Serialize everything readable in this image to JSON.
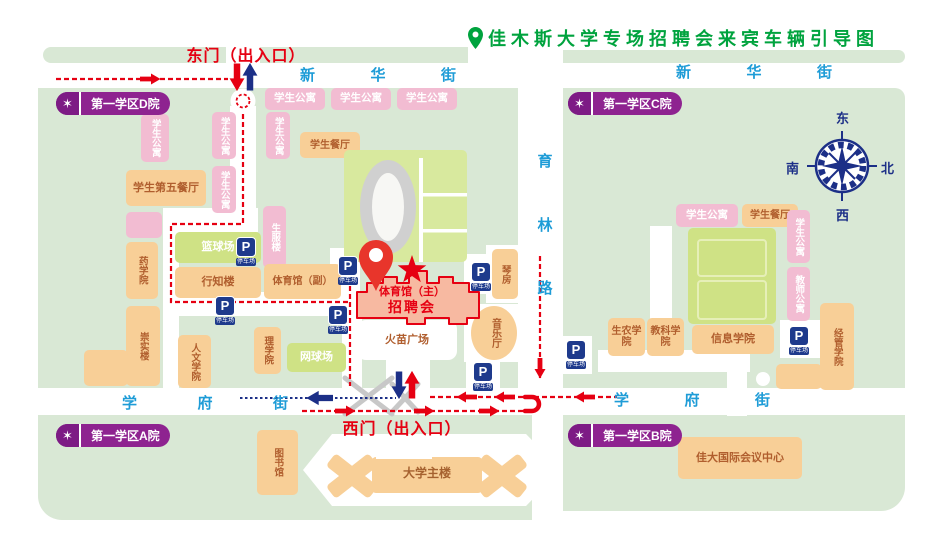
{
  "title": {
    "text": "佳木斯大学专场招聘会来宾车辆引导图"
  },
  "gates": {
    "east": "东门（出入口）",
    "west": "西门（出入口）"
  },
  "streets": {
    "xinhua": "新华街",
    "xuefu": "学府街",
    "yulin": "育林路"
  },
  "compass": {
    "top": "东",
    "right": "北",
    "bottom": "西",
    "left": "南"
  },
  "badge_star": "✶",
  "badges": [
    {
      "id": "district-d",
      "label": "第一学区D院",
      "x": 56,
      "y": 92
    },
    {
      "id": "district-c",
      "label": "第一学区C院",
      "x": 568,
      "y": 92
    },
    {
      "id": "district-a",
      "label": "第一学区A院",
      "x": 56,
      "y": 424
    },
    {
      "id": "district-b",
      "label": "第一学区B院",
      "x": 568,
      "y": 424
    }
  ],
  "venue": {
    "line1": "体育馆（主）",
    "line2": "招聘会"
  },
  "parking": {
    "symbol": "P",
    "caption": "停车场",
    "spots": [
      {
        "x": 236,
        "y": 237
      },
      {
        "x": 215,
        "y": 296
      },
      {
        "x": 338,
        "y": 256
      },
      {
        "x": 328,
        "y": 305
      },
      {
        "x": 471,
        "y": 262
      },
      {
        "x": 473,
        "y": 362
      },
      {
        "x": 566,
        "y": 340
      },
      {
        "x": 789,
        "y": 326
      }
    ]
  },
  "map": {
    "buildings": [
      {
        "id": "apt-w1",
        "label": "学生公寓",
        "x": 265,
        "y": 88,
        "w": 60,
        "h": 22,
        "kind": "pink"
      },
      {
        "id": "apt-w2",
        "label": "学生公寓",
        "x": 331,
        "y": 88,
        "w": 60,
        "h": 22,
        "kind": "pink"
      },
      {
        "id": "apt-w3",
        "label": "学生公寓",
        "x": 397,
        "y": 88,
        "w": 60,
        "h": 22,
        "kind": "pink"
      },
      {
        "id": "apt-w4",
        "label": "学生公寓",
        "x": 141,
        "y": 114,
        "w": 28,
        "h": 48,
        "kind": "pink",
        "v": 1
      },
      {
        "id": "apt-w5",
        "label": "学生公寓",
        "x": 212,
        "y": 112,
        "w": 24,
        "h": 47,
        "kind": "pink",
        "v": 1
      },
      {
        "id": "apt-w6",
        "label": "学生公寓",
        "x": 212,
        "y": 166,
        "w": 24,
        "h": 47,
        "kind": "pink",
        "v": 1
      },
      {
        "id": "apt-w7",
        "label": "学生公寓",
        "x": 266,
        "y": 112,
        "w": 24,
        "h": 47,
        "kind": "pink",
        "v": 1
      },
      {
        "id": "canteen-west",
        "label": "学生餐厅",
        "x": 300,
        "y": 132,
        "w": 60,
        "h": 26,
        "kind": "orange",
        "fs": 10
      },
      {
        "id": "canteen-no5",
        "label": "学生第五餐厅",
        "x": 126,
        "y": 170,
        "w": 80,
        "h": 36,
        "kind": "orange",
        "fs": 11
      },
      {
        "id": "annex",
        "label": "",
        "x": 126,
        "y": 212,
        "w": 36,
        "h": 26,
        "kind": "pink"
      },
      {
        "id": "pharmacy-college",
        "label": "药学院",
        "x": 126,
        "y": 242,
        "w": 32,
        "h": 57,
        "kind": "orange",
        "v": 1
      },
      {
        "id": "chongshi-bldg",
        "label": "崇实楼",
        "x": 126,
        "y": 306,
        "w": 34,
        "h": 80,
        "kind": "orange",
        "v": 1
      },
      {
        "id": "chongshi-foot",
        "label": "",
        "x": 84,
        "y": 350,
        "w": 44,
        "h": 36,
        "kind": "orange"
      },
      {
        "id": "shengfu-bldg",
        "label": "生服楼",
        "x": 263,
        "y": 206,
        "w": 23,
        "h": 62,
        "kind": "pink",
        "v": 1
      },
      {
        "id": "basketball-court",
        "label": "篮球场",
        "x": 175,
        "y": 232,
        "w": 86,
        "h": 31,
        "kind": "court"
      },
      {
        "id": "xingzhi-bldg",
        "label": "行知楼",
        "x": 175,
        "y": 267,
        "w": 86,
        "h": 31,
        "kind": "orange",
        "fs": 11
      },
      {
        "id": "gym-aux",
        "label": "体育馆（副）",
        "x": 264,
        "y": 264,
        "w": 77,
        "h": 35,
        "kind": "orange",
        "fs": 10
      },
      {
        "id": "humanities-college",
        "label": "人文学院",
        "x": 178,
        "y": 335,
        "w": 33,
        "h": 53,
        "kind": "orange",
        "v": 1
      },
      {
        "id": "science-college",
        "label": "理学院",
        "x": 254,
        "y": 327,
        "w": 27,
        "h": 47,
        "kind": "orange",
        "v": 1
      },
      {
        "id": "tennis-court",
        "label": "网球场",
        "x": 287,
        "y": 343,
        "w": 59,
        "h": 29,
        "kind": "court"
      },
      {
        "id": "library",
        "label": "图书馆",
        "x": 257,
        "y": 430,
        "w": 41,
        "h": 65,
        "kind": "orange",
        "v": 1
      },
      {
        "id": "stadium-field",
        "label": "",
        "x": 344,
        "y": 150,
        "w": 123,
        "h": 112,
        "kind": "field"
      },
      {
        "id": "stadium-label",
        "label": "体育场",
        "x": 377,
        "y": 172,
        "w": 21,
        "h": 76,
        "kind": "slabel",
        "v": 1,
        "fs": 11
      },
      {
        "id": "piano-rooms",
        "label": "琴房",
        "x": 492,
        "y": 249,
        "w": 26,
        "h": 50,
        "kind": "orange",
        "v": 1
      },
      {
        "id": "music-hall-label",
        "label": "音乐厅",
        "x": 484,
        "y": 309,
        "w": 21,
        "h": 48,
        "kind": "olabel",
        "v": 1,
        "fs": 10
      },
      {
        "id": "flame-plaza",
        "label": "火苗广场",
        "x": 357,
        "y": 320,
        "w": 100,
        "h": 40,
        "kind": "plaza",
        "fs": 11
      },
      {
        "id": "main-bldg-label",
        "label": "大学主楼",
        "x": 372,
        "y": 462,
        "w": 110,
        "h": 24,
        "kind": "tlabel"
      },
      {
        "id": "apt-e1",
        "label": "学生公寓",
        "x": 676,
        "y": 204,
        "w": 62,
        "h": 23,
        "kind": "pink"
      },
      {
        "id": "canteen-east",
        "label": "学生餐厅",
        "x": 742,
        "y": 204,
        "w": 56,
        "h": 23,
        "kind": "orange",
        "fs": 10
      },
      {
        "id": "apt-e2",
        "label": "学生公寓",
        "x": 787,
        "y": 210,
        "w": 23,
        "h": 53,
        "kind": "pink",
        "v": 1
      },
      {
        "id": "teacher-apt",
        "label": "教师公寓",
        "x": 787,
        "y": 267,
        "w": 23,
        "h": 54,
        "kind": "pink",
        "v": 1
      },
      {
        "id": "courts-east",
        "label": "",
        "x": 688,
        "y": 228,
        "w": 88,
        "h": 96,
        "kind": "court"
      },
      {
        "id": "shengnong-college",
        "label": "生农学院",
        "x": 608,
        "y": 318,
        "w": 37,
        "h": 38,
        "kind": "orange",
        "fs": 10
      },
      {
        "id": "jiaoke-college",
        "label": "教科学院",
        "x": 647,
        "y": 318,
        "w": 37,
        "h": 38,
        "kind": "orange",
        "fs": 10
      },
      {
        "id": "info-college",
        "label": "信息学院",
        "x": 692,
        "y": 325,
        "w": 82,
        "h": 29,
        "kind": "orange",
        "fs": 11
      },
      {
        "id": "jingguan-college",
        "label": "经管学院",
        "x": 820,
        "y": 303,
        "w": 34,
        "h": 87,
        "kind": "orange",
        "v": 1
      },
      {
        "id": "jingguan-foot",
        "label": "",
        "x": 776,
        "y": 364,
        "w": 46,
        "h": 25,
        "kind": "orange"
      },
      {
        "id": "conference-center",
        "label": "佳大国际会议中心",
        "x": 678,
        "y": 437,
        "w": 124,
        "h": 42,
        "kind": "orange",
        "fs": 11
      }
    ]
  }
}
